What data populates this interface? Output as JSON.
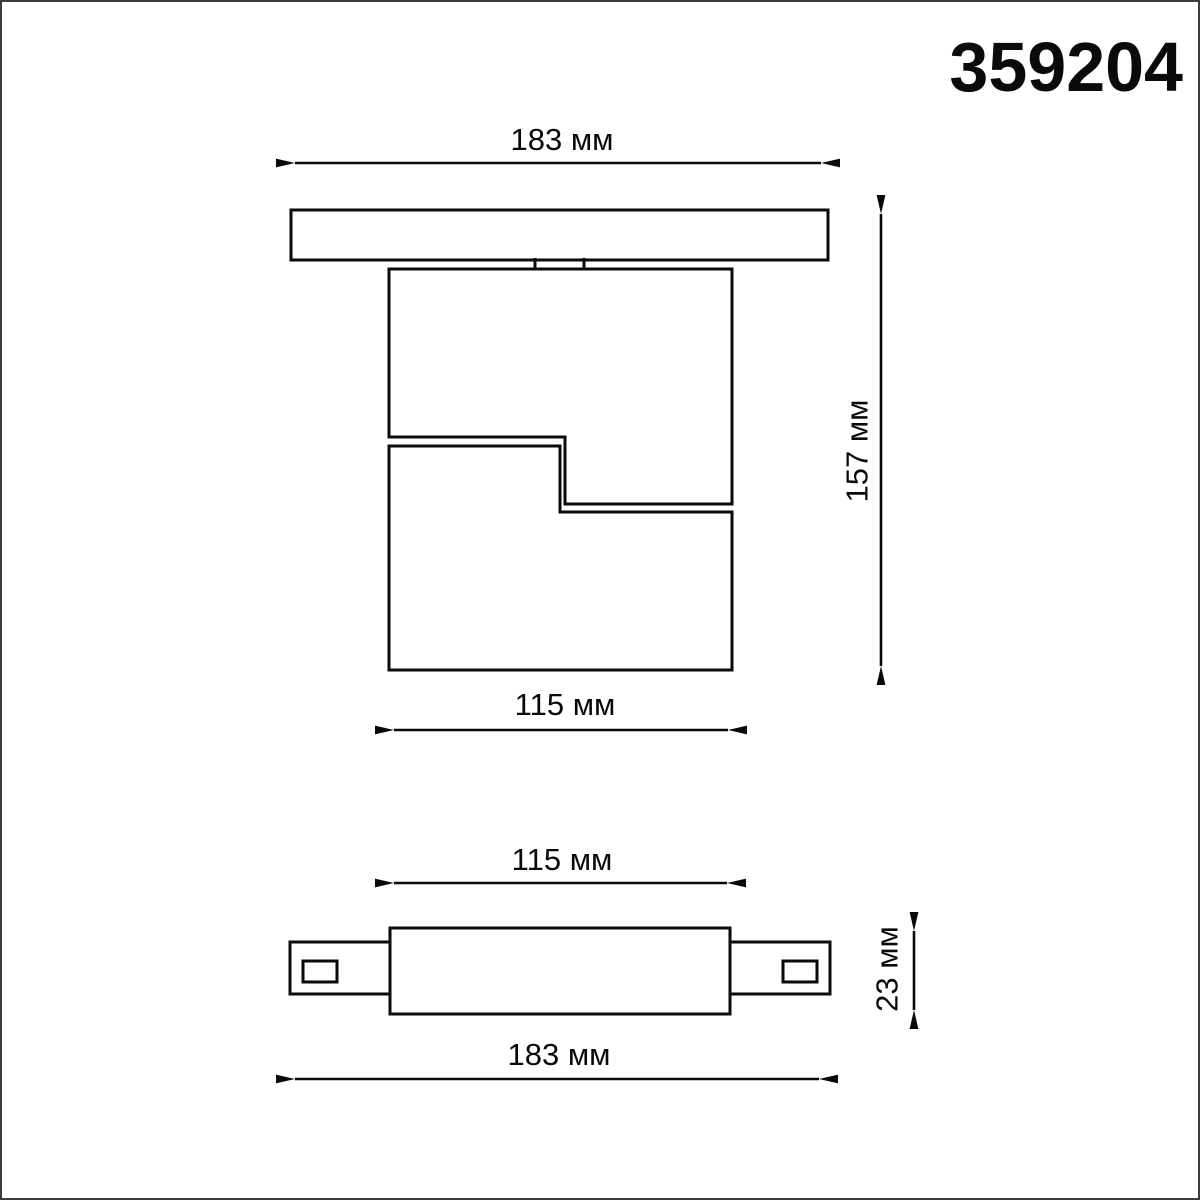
{
  "page": {
    "background_color": "#ffffff",
    "border_color": "#3c3c3c",
    "line_color": "#0a0a0a"
  },
  "header": {
    "model_number": "359204"
  },
  "front_view": {
    "track_width_label": "183 мм",
    "overall_height_label": "157 мм",
    "body_width_label": "115 мм"
  },
  "bottom_view": {
    "body_width_label": "115 мм",
    "connector_height_label": "23 мм",
    "overall_width_label": "183 мм"
  }
}
